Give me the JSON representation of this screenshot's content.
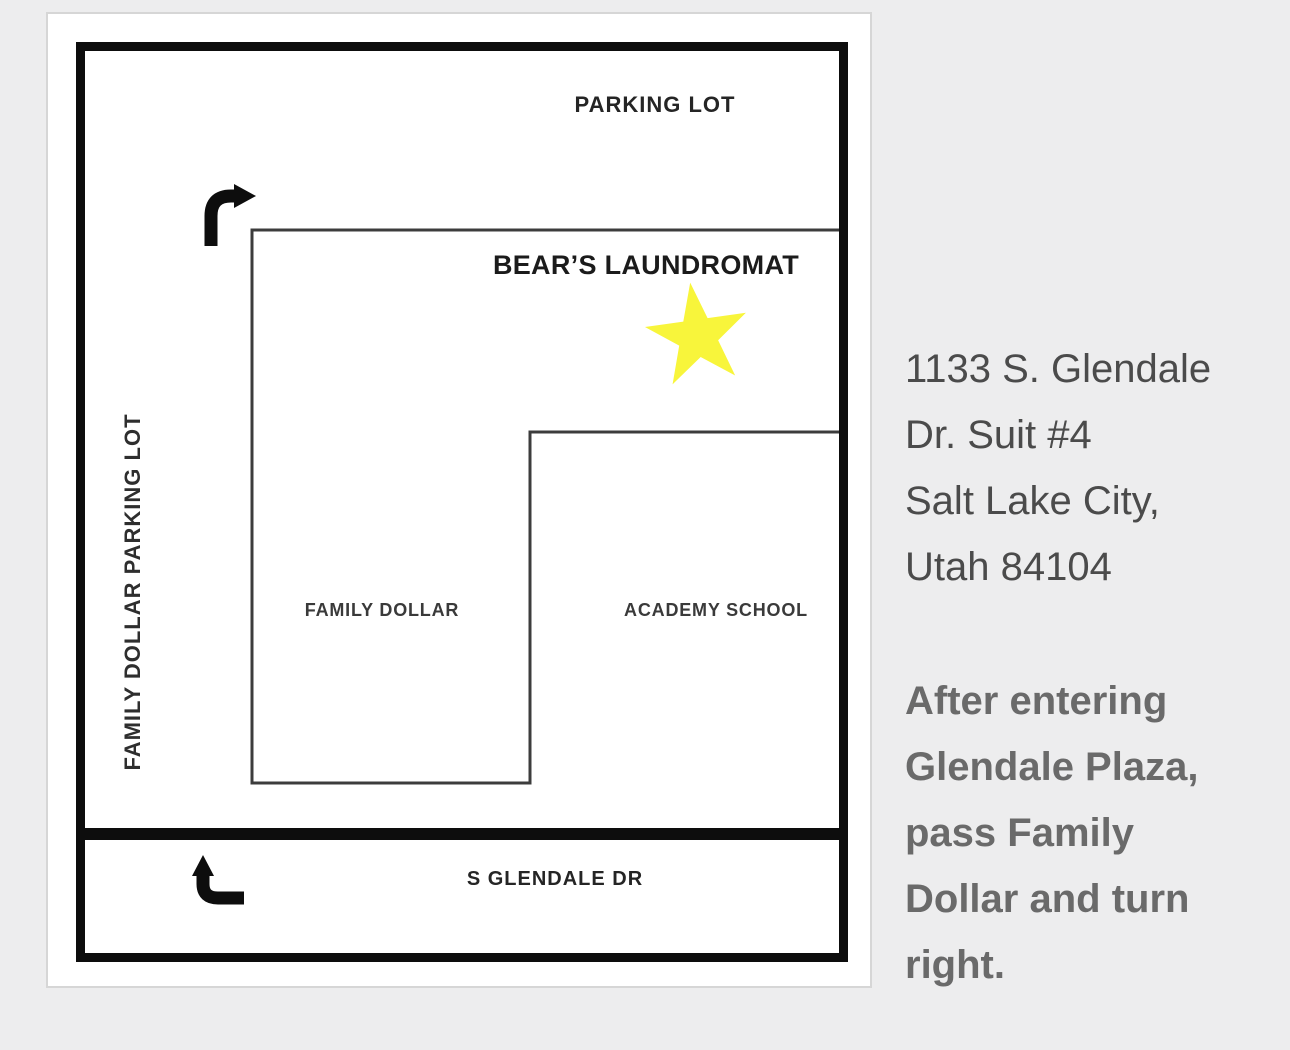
{
  "map": {
    "parking_lot_label": "PARKING LOT",
    "laundromat_label": "BEAR’S LAUNDROMAT",
    "family_dollar_parking_label": "FAMILY DOLLAR PARKING LOT",
    "family_dollar_label": "FAMILY DOLLAR",
    "academy_school_label": "ACADEMY SCHOOL",
    "street_label": "S GLENDALE DR"
  },
  "address": {
    "lines": [
      "1133 S. Glendale",
      "Dr. Suit #4",
      "Salt Lake City,",
      "Utah 84104"
    ]
  },
  "directions": {
    "lines": [
      "After entering",
      "Glendale Plaza,",
      "pass Family",
      "Dollar and turn",
      "right."
    ]
  },
  "colors": {
    "page_bg": "#ededee",
    "card_bg": "#ffffff",
    "card_border": "#d6d6d6",
    "map_border": "#0d0d0d",
    "outline": "#3c3c3c",
    "star_fill": "#f8f53b",
    "address_text": "#4b4b4b",
    "directions_text": "#6a6a6a",
    "map_text": "#252525"
  }
}
